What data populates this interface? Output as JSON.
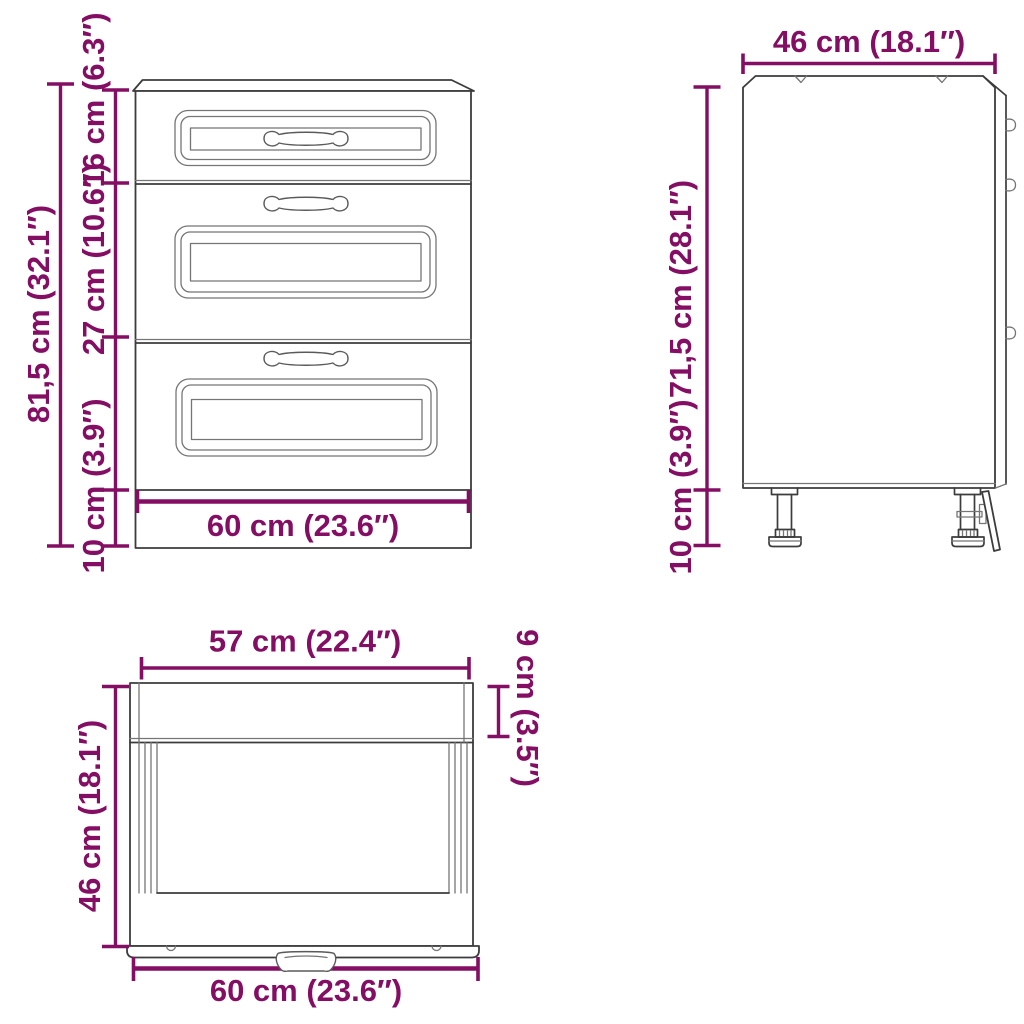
{
  "diagram_title": "kitchen-base-cabinet-dimension-drawing",
  "colors": {
    "dimension_accent": "#840e63",
    "outline": "#3c3c3c",
    "background": "#ffffff"
  },
  "views": {
    "front": {
      "dims": {
        "total_height": "81,5 cm (32.1″)",
        "top_drawer_height": "16 cm (6.3″)",
        "middle_drawer_height": "27 cm (10.6″)",
        "base_height": "10 cm (3.9″)",
        "width": "60 cm (23.6″)"
      }
    },
    "side": {
      "dims": {
        "depth": "46 cm (18.1″)",
        "body_height": "71,5 cm (28.1″)",
        "feet_height": "10 cm (3.9″)"
      }
    },
    "top": {
      "dims": {
        "inner_width": "57 cm (22.4″)",
        "front_edge_depth": "9 cm (3.5″)",
        "depth": "46 cm (18.1″)",
        "width": "60 cm (23.6″)"
      }
    }
  }
}
